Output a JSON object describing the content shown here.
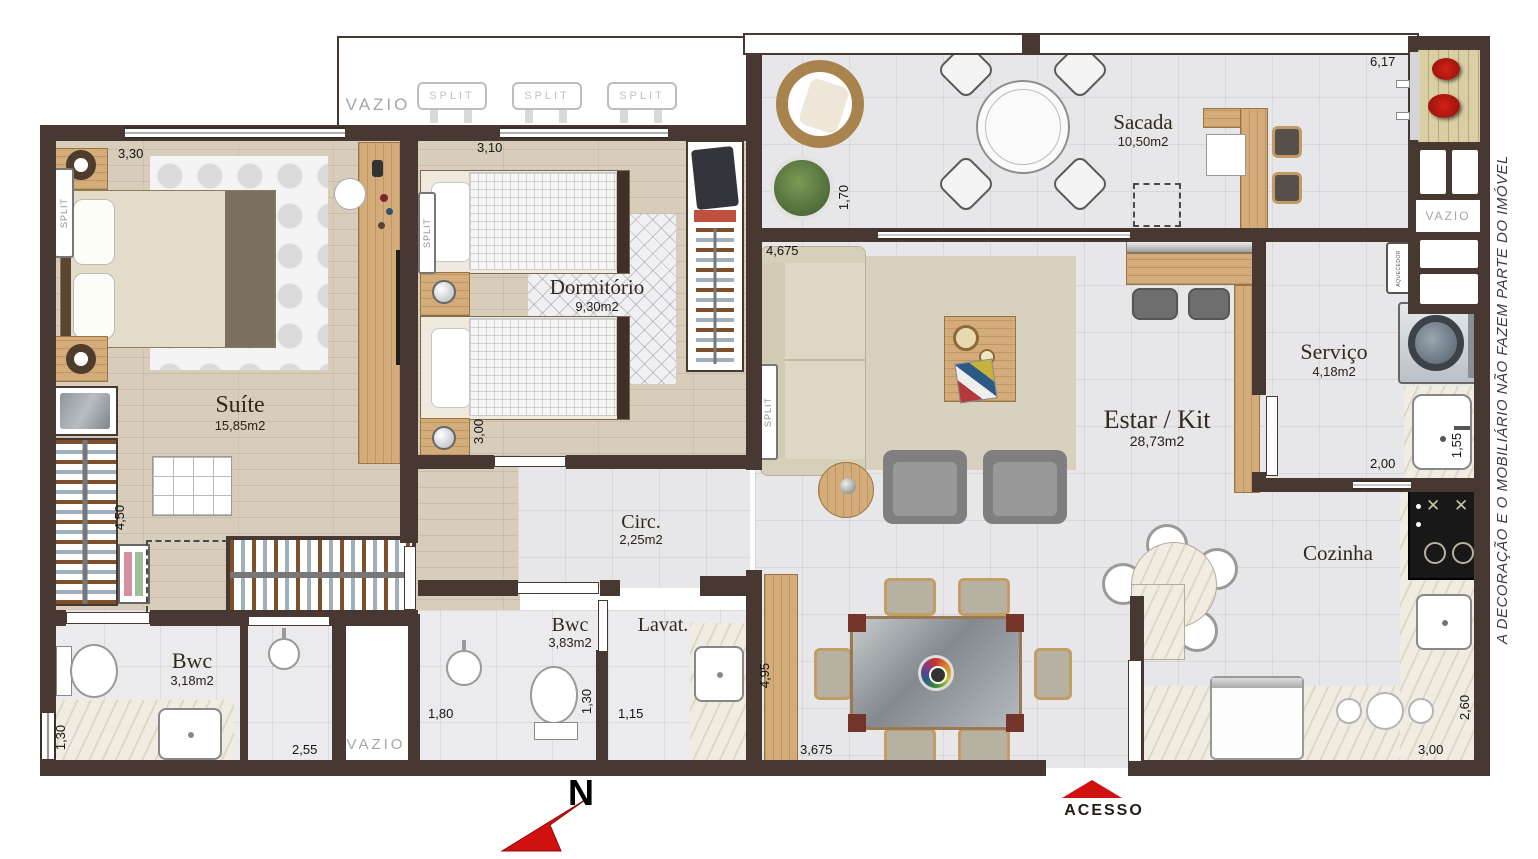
{
  "disclaimer": "A  DECORAÇÃO E O MOBILIÁRIO NÃO FAZEM PARTE DO IMÓVEL",
  "compass": {
    "north": "N"
  },
  "entrance": {
    "label": "ACESSO"
  },
  "shared": {
    "vazio": "VAZIO",
    "split": "SPLIT",
    "aquecedor": "AQUECEDOR"
  },
  "rooms": {
    "suite": {
      "name": "Suíte",
      "area": "15,85m2"
    },
    "dormitorio": {
      "name": "Dormitório",
      "area": "9,30m2"
    },
    "sacada": {
      "name": "Sacada",
      "area": "10,50m2"
    },
    "estar_kit": {
      "name": "Estar / Kit",
      "area": "28,73m2"
    },
    "servico": {
      "name": "Serviço",
      "area": "4,18m2"
    },
    "cozinha": {
      "name": "Cozinha"
    },
    "circulacao": {
      "name": "Circ.",
      "area": "2,25m2"
    },
    "bwc_suite": {
      "name": "Bwc",
      "area": "3,18m2"
    },
    "bwc_social": {
      "name": "Bwc",
      "area": "3,83m2"
    },
    "lavatorio": {
      "name": "Lavat."
    }
  },
  "dimensions": {
    "suite_width": "3,30",
    "suite_depth": "4,50",
    "dorm_width": "3,10",
    "dorm_depth": "3,00",
    "sacada_width": "6,17",
    "sacada_depth": "1,70",
    "estar_width": "4,675",
    "estar_depth": "4,95",
    "estar_bottom": "3,675",
    "servico_width": "2,00",
    "tanque_depth": "1,55",
    "cozinha_width": "3,00",
    "cozinha_depth": "2,60",
    "bwc_suite_depth": "1,30",
    "shower_width": "2,55",
    "bwc_social_width": "1,80",
    "bwc_social_depth": "1,30",
    "lavat_width": "1,15"
  },
  "colors": {
    "wall": "#473831",
    "wood_floor": "#d8cdbb",
    "tile": "#e7e7e9",
    "marble": "#f1ece2",
    "furniture_wood": "#d3ac79",
    "accent_red": "#cf1110"
  }
}
